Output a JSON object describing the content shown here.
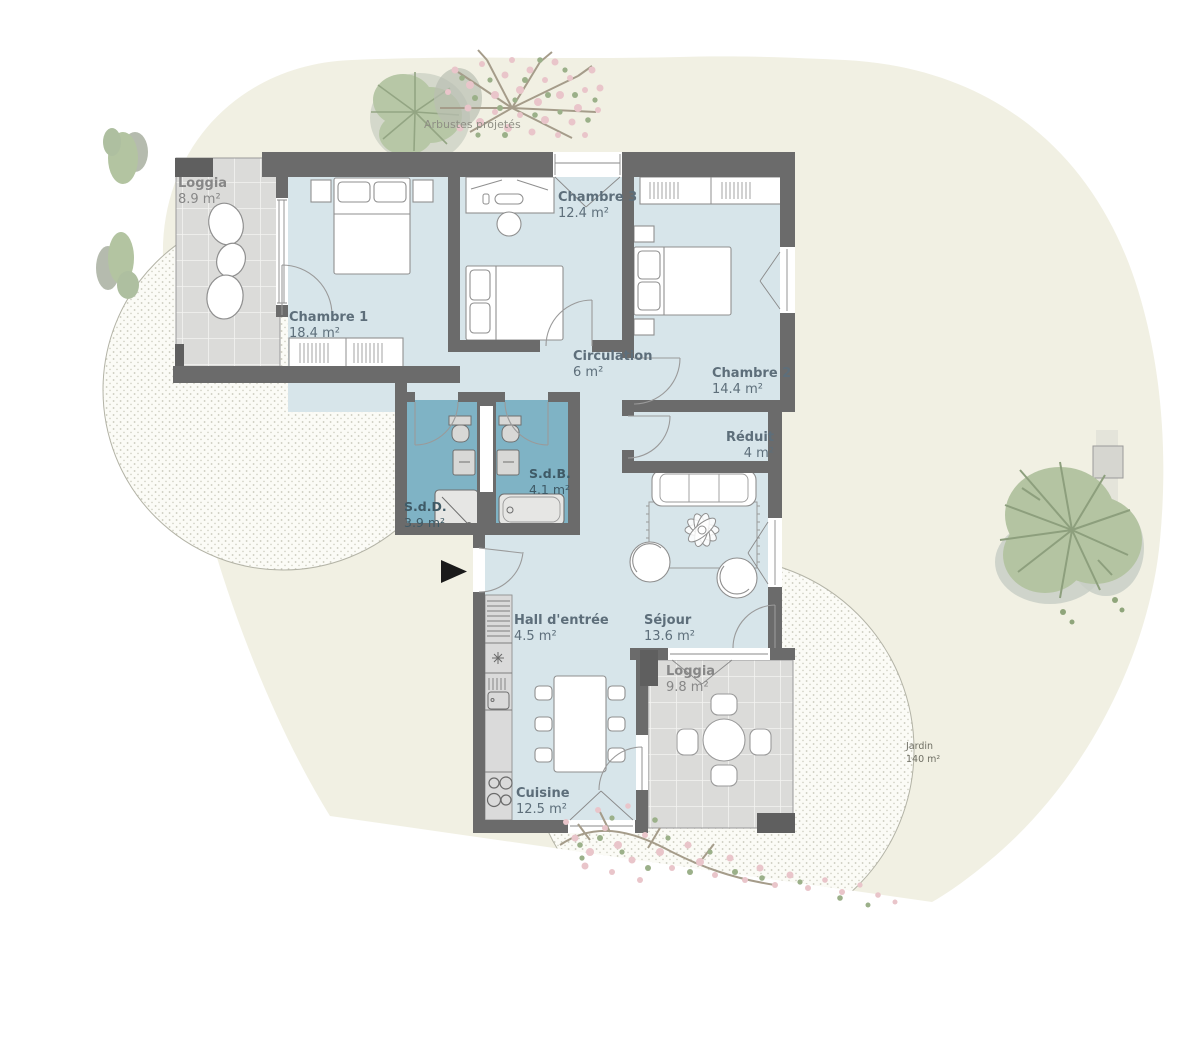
{
  "garden": {
    "label": "Jardin",
    "area": "140 m²",
    "note": "Arbustes projetés"
  },
  "rooms": [
    {
      "id": "loggia-1",
      "name": "Loggia",
      "area": "8.9 m²"
    },
    {
      "id": "chambre-1",
      "name": "Chambre 1",
      "area": "18.4 m²"
    },
    {
      "id": "chambre-3",
      "name": "Chambre 3",
      "area": "12.4 m²"
    },
    {
      "id": "chambre-2",
      "name": "Chambre 2",
      "area": "14.4 m²"
    },
    {
      "id": "circulation",
      "name": "Circulation",
      "area": "6 m²"
    },
    {
      "id": "reduit",
      "name": "Réduit",
      "area": "4 m²"
    },
    {
      "id": "sdb",
      "name": "S.d.B.",
      "area": "4.1 m²"
    },
    {
      "id": "sdd",
      "name": "S.d.D.",
      "area": "3.9 m²"
    },
    {
      "id": "hall",
      "name": "Hall d'entrée",
      "area": "4.5 m²"
    },
    {
      "id": "sejour",
      "name": "Séjour",
      "area": "13.6 m²"
    },
    {
      "id": "loggia-2",
      "name": "Loggia",
      "area": "9.8 m²"
    },
    {
      "id": "cuisine",
      "name": "Cuisine",
      "area": "12.5 m²"
    }
  ],
  "colors": {
    "wall_gray": "#6b6b6b",
    "room_blue": "#d7e5ea",
    "bathroom_blue": "#7fb3c5",
    "loggia_tile": "#dbdbd9",
    "garden_beige": "#f1f0e3",
    "tree_green": "#b4c4a2",
    "blossom_pink": "#e9c5ca",
    "arrow_black": "#1a1a1a"
  }
}
